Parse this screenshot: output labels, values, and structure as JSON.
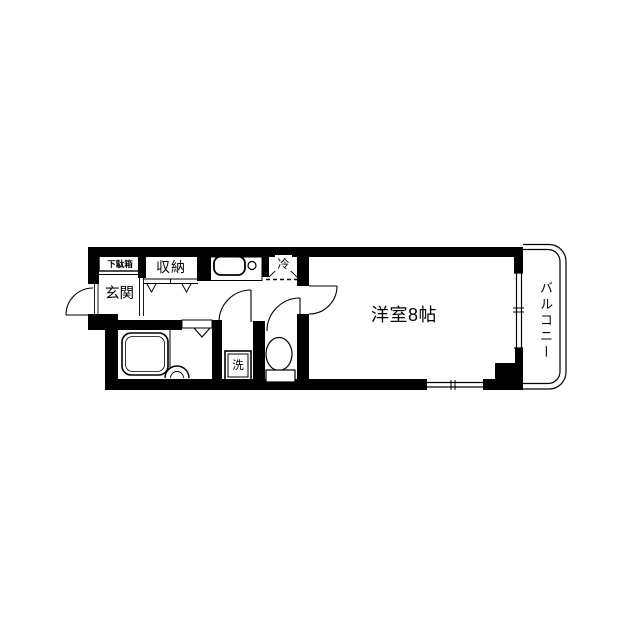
{
  "plan": {
    "type": "apartment-floor-plan",
    "colors": {
      "line": "#000000",
      "background": "#ffffff"
    },
    "rooms": {
      "entrance": {
        "label": "玄関"
      },
      "shoe_cabinet": {
        "label": "下駄箱"
      },
      "closet": {
        "label": "収納"
      },
      "refrigerator_space": {
        "label": "冷"
      },
      "washing_machine": {
        "label": "洗"
      },
      "western_room": {
        "label": "洋室8帖",
        "size_tatami": "8帖"
      },
      "balcony": {
        "label": "バルコニー"
      }
    }
  }
}
